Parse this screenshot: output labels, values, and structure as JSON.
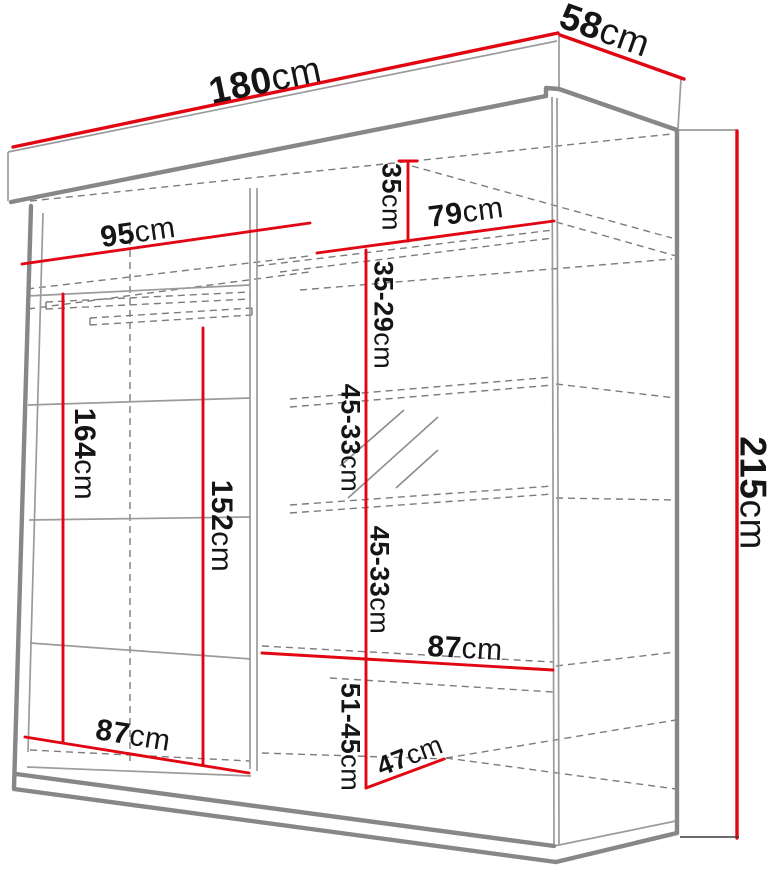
{
  "diagram": {
    "subject": "wardrobe-dimension-drawing",
    "unit": "cm",
    "accent_color": "#e20613",
    "line_color": "#8a8a8a"
  },
  "dims": {
    "overall_width": {
      "value": "180",
      "unit": "cm"
    },
    "overall_depth": {
      "value": "58",
      "unit": "cm"
    },
    "overall_height": {
      "value": "215",
      "unit": "cm"
    },
    "left_top_width": {
      "value": "95",
      "unit": "cm"
    },
    "right_top_width": {
      "value": "79",
      "unit": "cm"
    },
    "top_shelf_height": {
      "value": "35",
      "unit": "cm"
    },
    "upper_shelf_spacing": {
      "value": "35-29",
      "unit": "cm"
    },
    "middle_shelf_spacing_1": {
      "value": "45-33",
      "unit": "cm"
    },
    "middle_shelf_spacing_2": {
      "value": "45-33",
      "unit": "cm"
    },
    "right_bottom_width": {
      "value": "87",
      "unit": "cm"
    },
    "bottom_section_height": {
      "value": "51-45",
      "unit": "cm"
    },
    "bottom_shelf_depth": {
      "value": "47",
      "unit": "cm"
    },
    "left_bottom_width": {
      "value": "87",
      "unit": "cm"
    },
    "left_hanging_height": {
      "value": "164",
      "unit": "cm"
    },
    "left_rod_clearance": {
      "value": "152",
      "unit": "cm"
    }
  }
}
